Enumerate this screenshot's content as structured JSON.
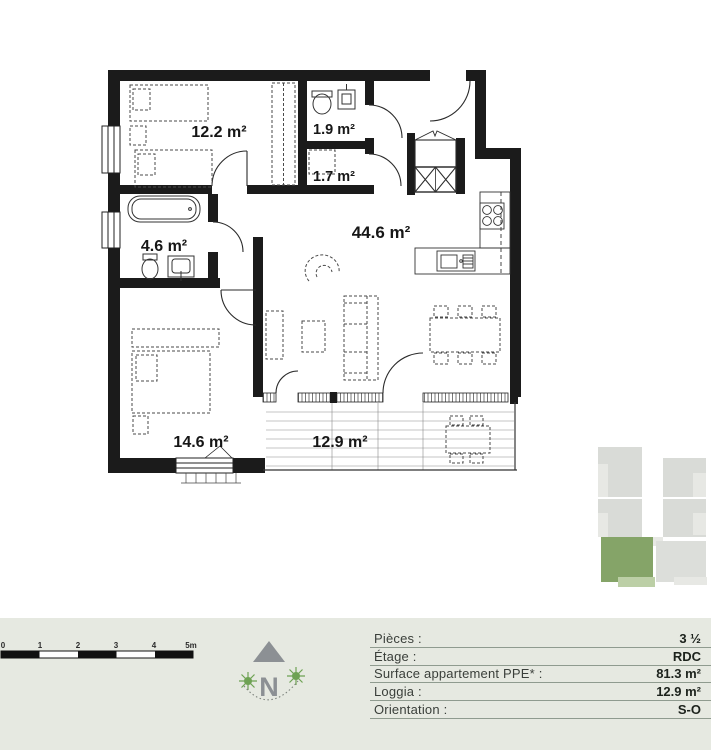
{
  "plan": {
    "rooms": [
      {
        "id": "bedroom-1",
        "label": "12.2 m²"
      },
      {
        "id": "wc",
        "label": "1.9 m²"
      },
      {
        "id": "storage",
        "label": "1.7 m²"
      },
      {
        "id": "bathroom",
        "label": "4.6 m²"
      },
      {
        "id": "living",
        "label": "44.6 m²"
      },
      {
        "id": "bedroom-2",
        "label": "14.6 m²"
      },
      {
        "id": "loggia",
        "label": "12.9 m²"
      }
    ],
    "colors": {
      "wall": "#1b1b1b",
      "furniture": "#4a4a4a",
      "label": "#161616"
    }
  },
  "site_plan": {
    "building_color": "#d9dbd7",
    "building_light": "#e7e8e4",
    "highlight_color": "#85a468",
    "loggia_color": "#bccfa6"
  },
  "footer": {
    "background": "#e6e9e1",
    "scale_bar": {
      "ticks": [
        "0",
        "1",
        "2",
        "3",
        "4",
        "5m"
      ]
    },
    "compass": {
      "letter": "N",
      "arrow_color": "#8c9094",
      "sun_color": "#6ea253"
    },
    "legend": {
      "line_color": "#8f9b8f",
      "rows": [
        {
          "label": "Pièces :",
          "value": "3 ½"
        },
        {
          "label": "Étage :",
          "value": "RDC"
        },
        {
          "label": "Surface appartement PPE* :",
          "value": "81.3 m²"
        },
        {
          "label": "Loggia :",
          "value": "12.9 m²"
        },
        {
          "label": "Orientation :",
          "value": "S-O"
        }
      ]
    }
  }
}
